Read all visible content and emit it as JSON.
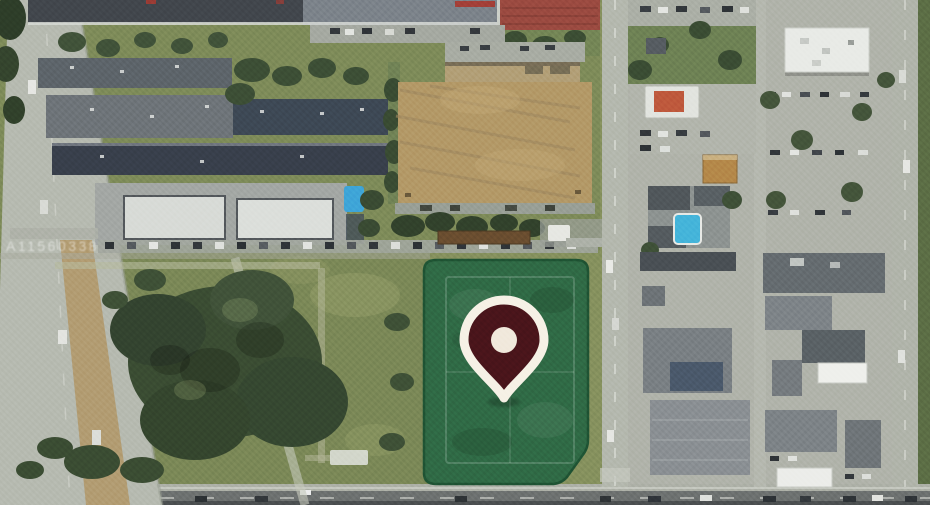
{
  "map": {
    "view_type": "satellite-aerial",
    "watermark": "A11560338",
    "colors": {
      "parcel_fill": "#2d6945",
      "parcel_border": "#1f5434",
      "pin_fill": "#4a151b",
      "pin_border": "#f6f1e6",
      "pin_dot": "#f1e9dc"
    }
  }
}
